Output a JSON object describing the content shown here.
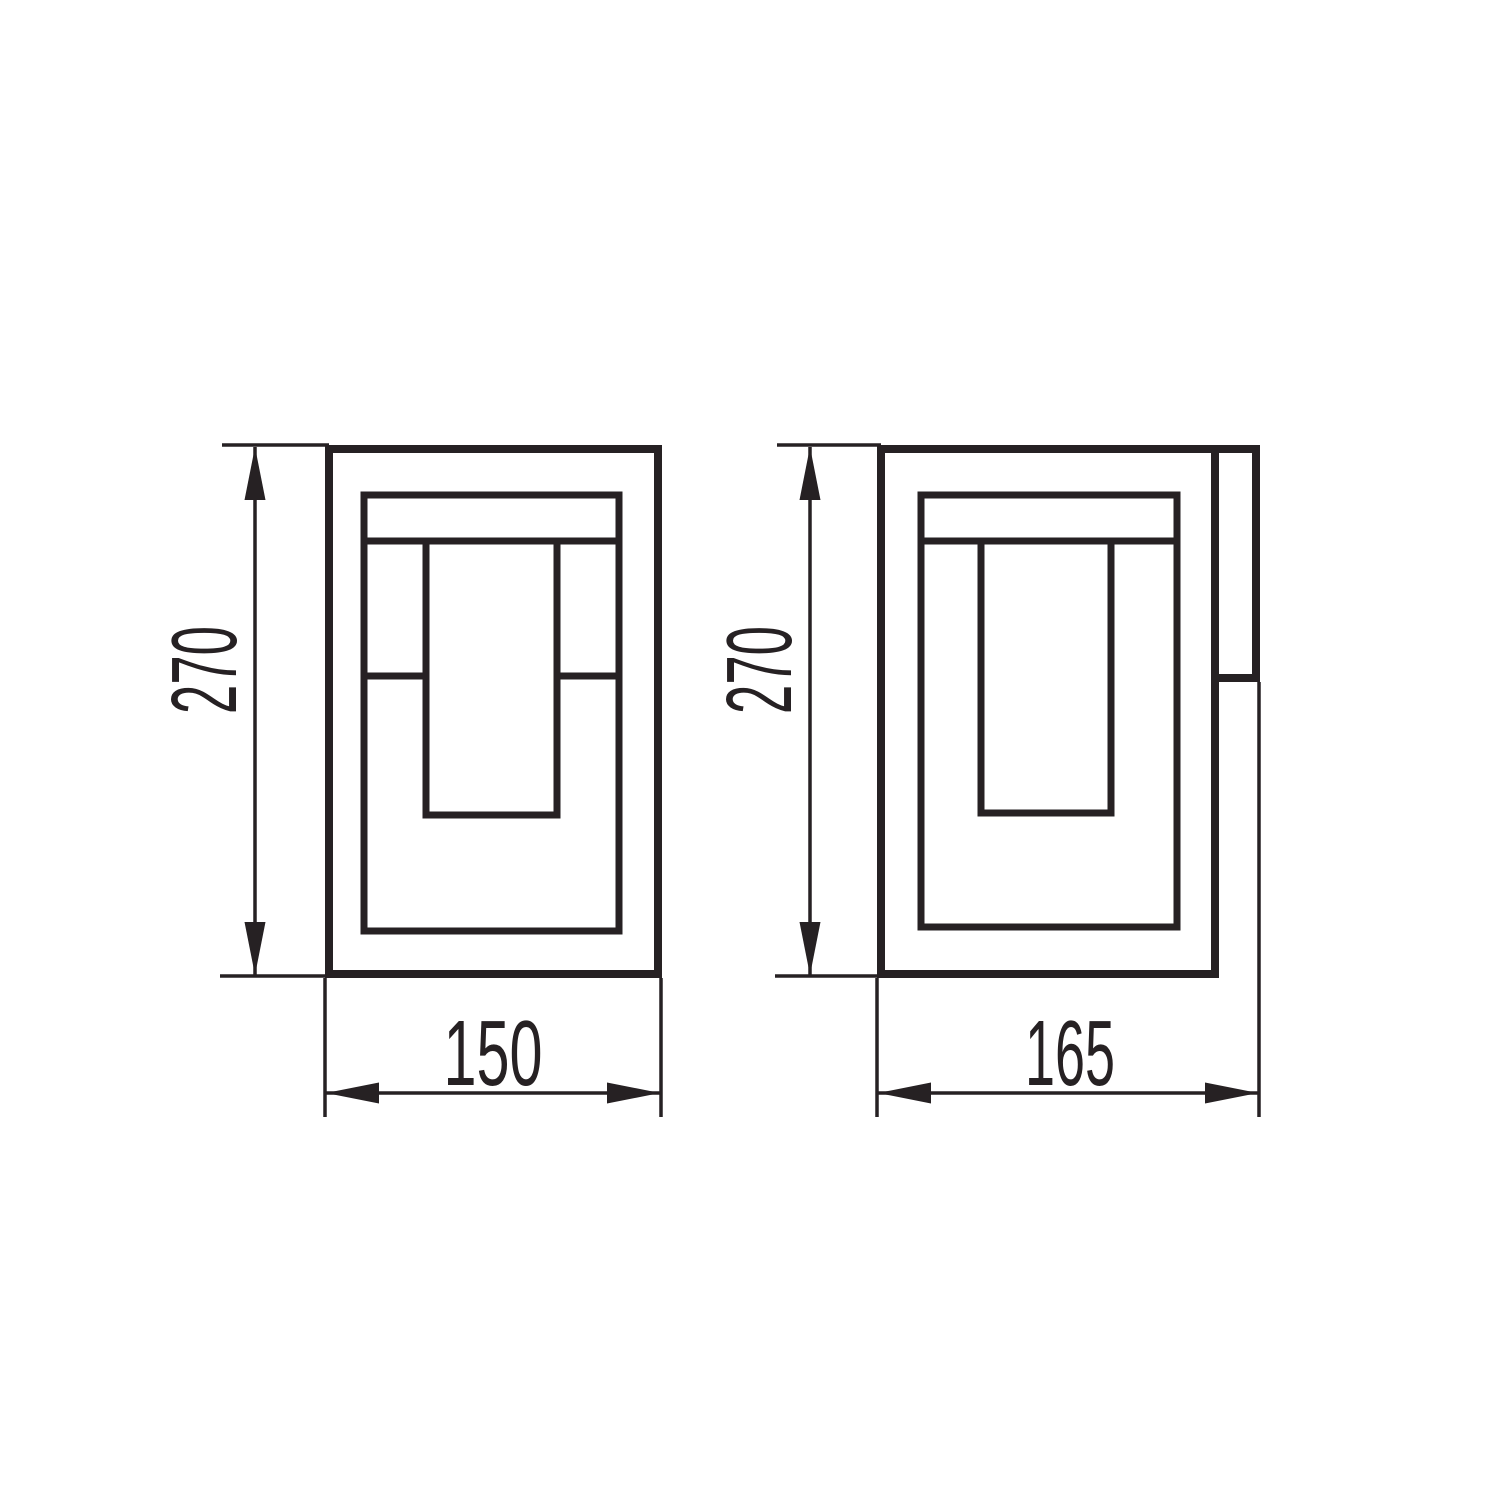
{
  "diagram": {
    "type": "technical-dimension-drawing",
    "background_color": "#ffffff",
    "ink_color": "#262123",
    "views": [
      {
        "id": "front-view",
        "description": "front elevation of rectangular lantern luminaire",
        "height_dimension": "270",
        "width_dimension": "150"
      },
      {
        "id": "side-view",
        "description": "side elevation of lantern luminaire with wall-mount bracket",
        "height_dimension": "270",
        "width_dimension": "165"
      }
    ]
  }
}
